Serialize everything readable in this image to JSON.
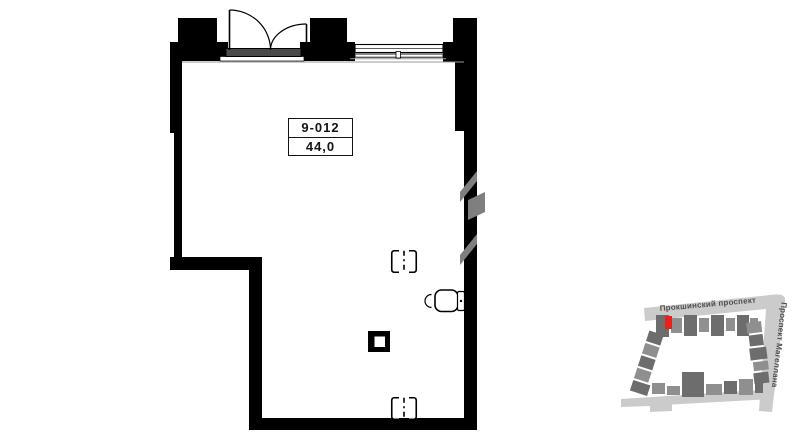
{
  "unit": {
    "number": "9-012",
    "area": "44,0"
  },
  "minimap": {
    "street_top": "Прокшинский проспект",
    "street_right": "Проспект Магеллана",
    "marker": "current-unit-highlight"
  },
  "plan": {
    "features": [
      "double-entry-door",
      "window",
      "toilet",
      "column",
      "utility-box-top",
      "utility-box-bottom",
      "shaft-hatch"
    ]
  },
  "colors": {
    "wall": "#000000",
    "hatch": "#7f7f7f",
    "sill": "#4a4a4a",
    "road": "#cbcbcb",
    "building": "#8f8f8f",
    "buildingDark": "#6d6d6d",
    "highlight": "#e8211d",
    "streetText": "#4f4f4f"
  }
}
